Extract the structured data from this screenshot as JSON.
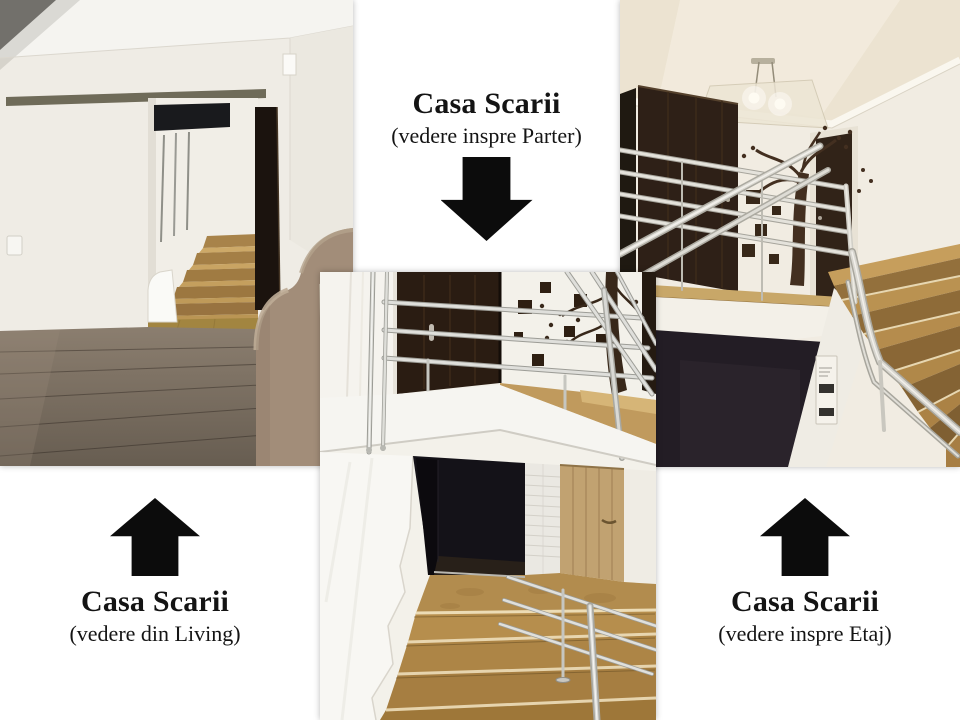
{
  "page": {
    "background_color": "#ffffff",
    "description": "Photo collage of a staircase (Casa Scarii) shown from three labelled viewpoints"
  },
  "captions": {
    "parter": {
      "title": "Casa Scarii",
      "subtitle": "(vedere inspre Parter)",
      "arrow_direction": "down"
    },
    "living": {
      "title": "Casa Scarii",
      "subtitle": "(vedere din Living)",
      "arrow_direction": "up"
    },
    "etaj": {
      "title": "Casa Scarii",
      "subtitle": "(vedere inspre Etaj)",
      "arrow_direction": "up"
    }
  },
  "photos": {
    "living_view": {
      "alt": "Living room with sliding frosted-glass doors, grey wood floor, beige sofa and wooden stairs seen through a doorway"
    },
    "parter_view": {
      "alt": "View down the tiled staircase toward the ground floor with stainless-steel railing, dark door and tree wall decal at the top"
    },
    "etaj_view": {
      "alt": "Staircase landing looking toward the upper floor with stainless-steel railing, two dark doors, tree wall decal and ceiling lamp"
    }
  },
  "colors": {
    "text": "#141414",
    "arrow": "#0c0c0c",
    "stair_wood": "#b8904f",
    "door_dark": "#261a12",
    "railing_steel": "#d6d6d2",
    "floor_wood_grey": "#7d7164",
    "sofa_taupe": "#a28d79"
  }
}
